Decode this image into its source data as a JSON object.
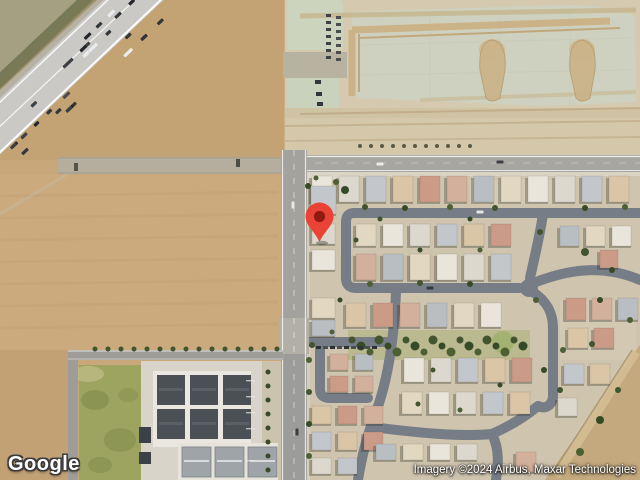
{
  "map": {
    "view_type": "satellite",
    "provider_logo": "Google",
    "attribution": "Imagery ©2024 Airbus, Maxar Technologies",
    "marker": {
      "color": "#EA4335",
      "inner_color": "#8E1A10",
      "x": 320,
      "y": 217
    },
    "colors": {
      "field_tan": "#c8a87b",
      "freeway_gray": "#cac9c5",
      "residential_street": "#777d87",
      "construction_green": "#ced1c0",
      "building_dark": "#4a5056",
      "grass_green": "#9da45f"
    }
  }
}
